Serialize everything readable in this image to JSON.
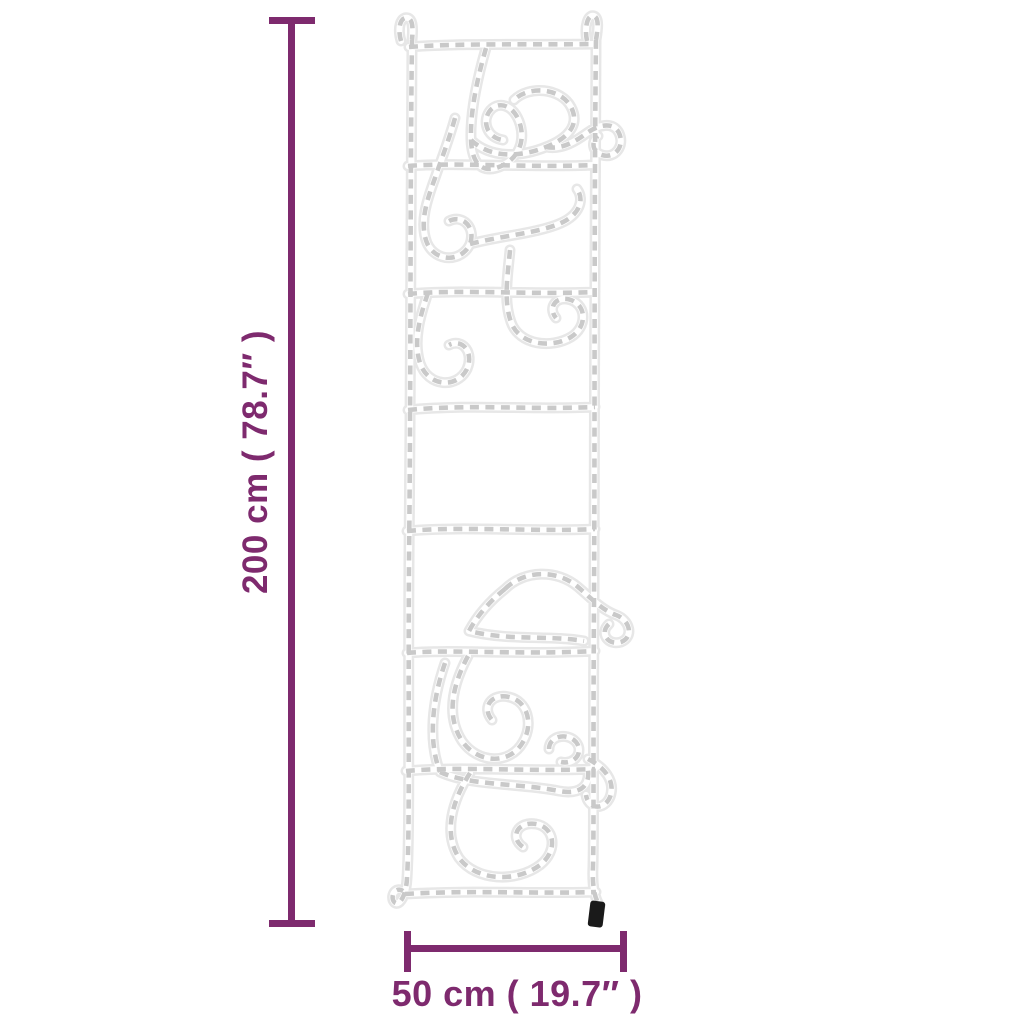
{
  "dimensions": {
    "height": {
      "label": "200 cm ( 78.7″ )"
    },
    "width": {
      "label": "50 cm ( 19.7″ )"
    }
  },
  "figure": {
    "type": "rope-light-ladder-with-climbing-santas",
    "segments": 7,
    "rungs": 8
  },
  "colors": {
    "accent": "#7e2a6e",
    "rope_tube": "#e7e7e7",
    "rope_core": "#ffffff",
    "rope_dash": "#c6c6c6",
    "plug": "#1a1a1a",
    "background": "#ffffff"
  }
}
